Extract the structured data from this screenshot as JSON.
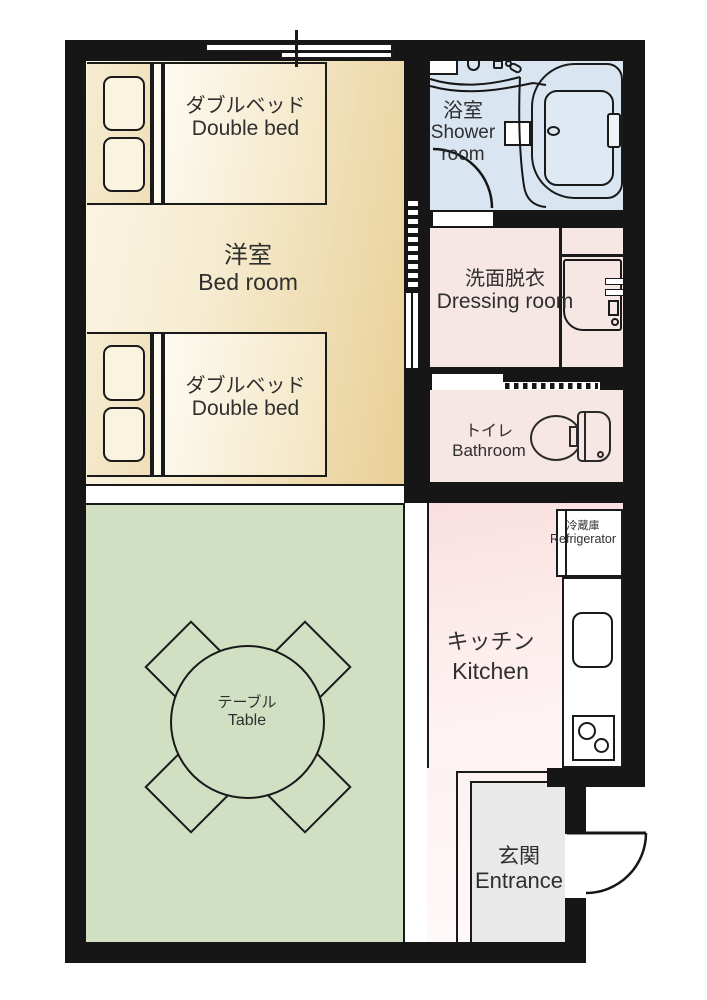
{
  "plan": {
    "type": "apartment-floor-plan",
    "wall_color": "#161616",
    "rooms": {
      "bedroom": {
        "ja": "洋室",
        "en": "Bed room",
        "floor": "#efdcae"
      },
      "living": {
        "floor": "#d1e0c3"
      },
      "shower": {
        "ja": "浴室",
        "en1": "Shower",
        "en2": "room",
        "floor": "#d9e5f1"
      },
      "dressing": {
        "ja": "洗面脱衣",
        "en": "Dressing room",
        "floor": "#f6e6e4"
      },
      "toilet": {
        "ja": "トイレ",
        "en": "Bathroom",
        "floor": "#f6e6e4"
      },
      "kitchen": {
        "ja": "キッチン",
        "en": "Kitchen",
        "floor": "#fbe7e6"
      },
      "entrance": {
        "ja": "玄関",
        "en": "Entrance",
        "floor": "#e9e9e9"
      }
    },
    "furniture": {
      "bed_top": {
        "ja": "ダブルベッド",
        "en": "Double bed"
      },
      "bed_bottom": {
        "ja": "ダブルベッド",
        "en": "Double bed"
      },
      "table": {
        "ja": "テーブル",
        "en": "Table"
      },
      "refrigerator": {
        "ja": "冷蔵庫",
        "en": "Refrigerator"
      }
    }
  }
}
